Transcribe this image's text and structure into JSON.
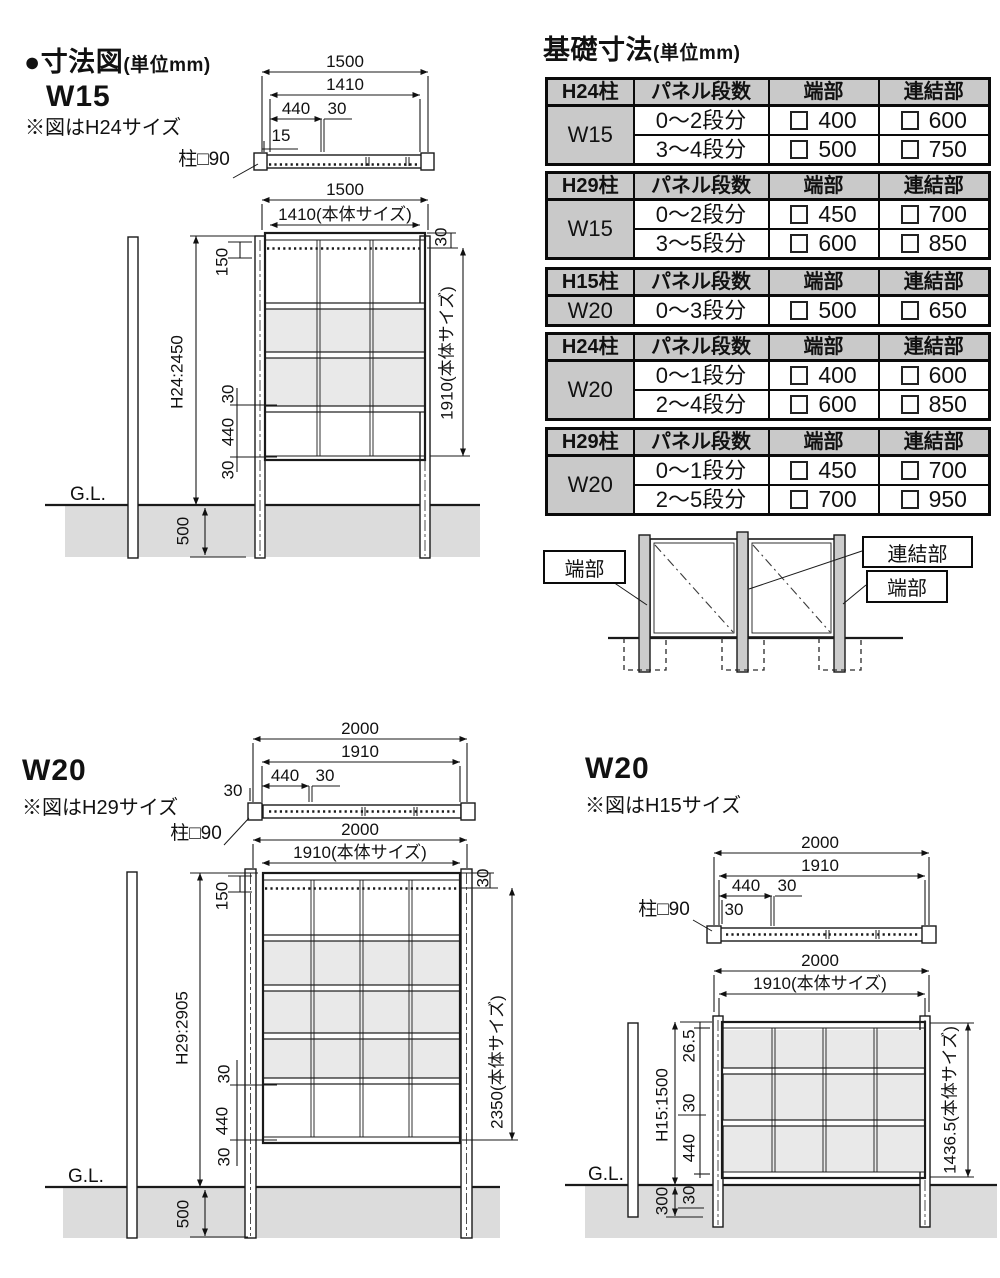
{
  "left_section": {
    "title": "●寸法図",
    "unit": "(単位mm)"
  },
  "w15": {
    "label": "W15",
    "note": "※図はH24サイズ"
  },
  "w20h29": {
    "label": "W20",
    "note": "※図はH29サイズ"
  },
  "w20h15": {
    "label": "W20",
    "note": "※図はH15サイズ"
  },
  "dims": {
    "d15": "15",
    "d26_5": "26.5",
    "d30": "30",
    "d150": "150",
    "d300": "300",
    "d440": "440",
    "d500": "500",
    "d1410": "1410",
    "d1500": "1500",
    "d1910": "1910",
    "d2000": "2000",
    "d1410_body": "1410(本体サイズ)",
    "d1910_body": "1910(本体サイズ)",
    "d2350_body": "2350(本体サイズ)",
    "d1436_body": "1436.5(本体サイズ)",
    "h24": "H24:2450",
    "h29": "H29:2905",
    "h15": "H15:1500",
    "gl": "G.L.",
    "post": "柱□90"
  },
  "foundation": {
    "title": "基礎寸法",
    "unit": "(単位mm)",
    "tables": [
      {
        "header": [
          "H24柱",
          "パネル段数",
          "端部",
          "連結部"
        ],
        "label": "W15",
        "rows": [
          [
            "0〜2段分",
            "400",
            "600"
          ],
          [
            "3〜4段分",
            "500",
            "750"
          ]
        ]
      },
      {
        "header": [
          "H29柱",
          "パネル段数",
          "端部",
          "連結部"
        ],
        "label": "W15",
        "rows": [
          [
            "0〜2段分",
            "450",
            "700"
          ],
          [
            "3〜5段分",
            "600",
            "850"
          ]
        ]
      },
      {
        "header": [
          "H15柱",
          "パネル段数",
          "端部",
          "連結部"
        ],
        "label": "W20",
        "rows": [
          [
            "0〜3段分",
            "500",
            "650"
          ]
        ]
      },
      {
        "header": [
          "H24柱",
          "パネル段数",
          "端部",
          "連結部"
        ],
        "label": "W20",
        "rows": [
          [
            "0〜1段分",
            "400",
            "600"
          ],
          [
            "2〜4段分",
            "600",
            "850"
          ]
        ]
      },
      {
        "header": [
          "H29柱",
          "パネル段数",
          "端部",
          "連結部"
        ],
        "label": "W20",
        "rows": [
          [
            "0〜1段分",
            "450",
            "700"
          ],
          [
            "2〜5段分",
            "700",
            "950"
          ]
        ]
      }
    ],
    "legend": {
      "left": "端部",
      "joint": "連結部",
      "right": "端部"
    }
  }
}
